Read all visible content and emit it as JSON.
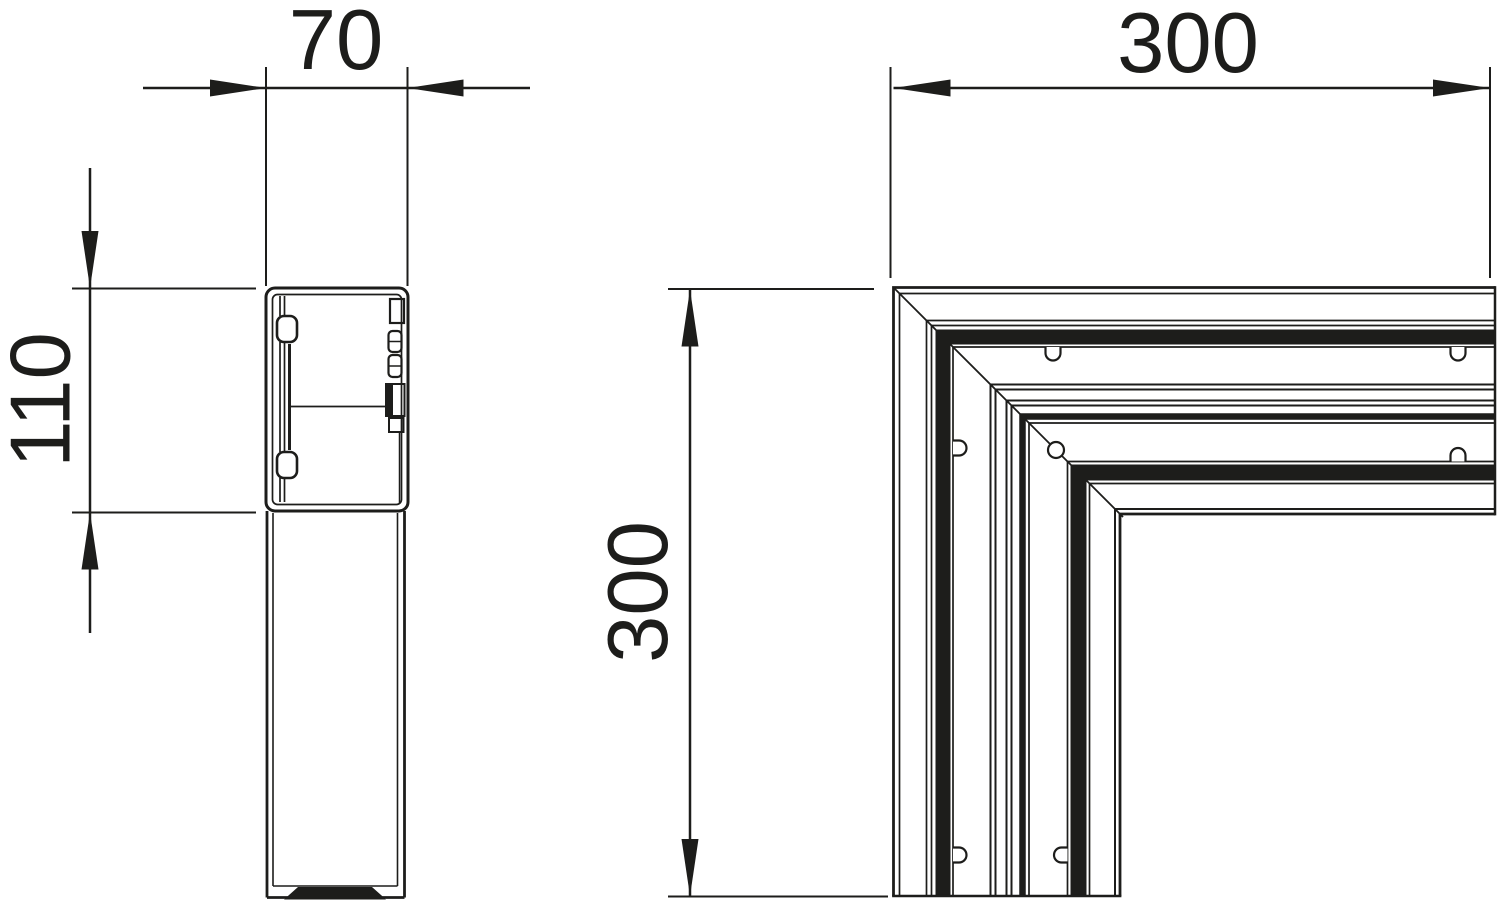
{
  "drawing": {
    "type": "technical-line-drawing",
    "subject": "trunking flat angle corner piece, side profile and plan view"
  },
  "colors": {
    "line": "#1d1d1b",
    "background": "#ffffff"
  },
  "dimensions": {
    "profile_width": "70",
    "profile_height": "110",
    "corner_width": "300",
    "corner_height": "300"
  }
}
